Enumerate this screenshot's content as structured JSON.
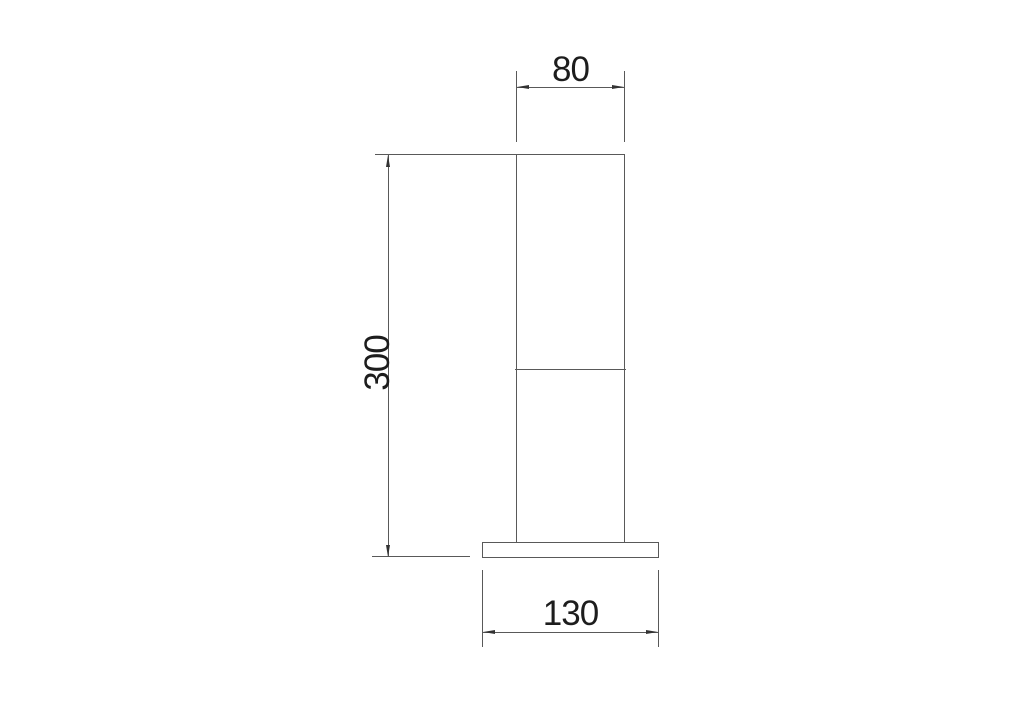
{
  "diagram": {
    "type": "technical-dimension-drawing",
    "dimensions": {
      "width_top": "80",
      "height_overall": "300",
      "width_base": "130"
    },
    "colors": {
      "background": "#ffffff",
      "line": "#595959",
      "arrow": "#333333",
      "text": "#1d1d1d"
    }
  }
}
